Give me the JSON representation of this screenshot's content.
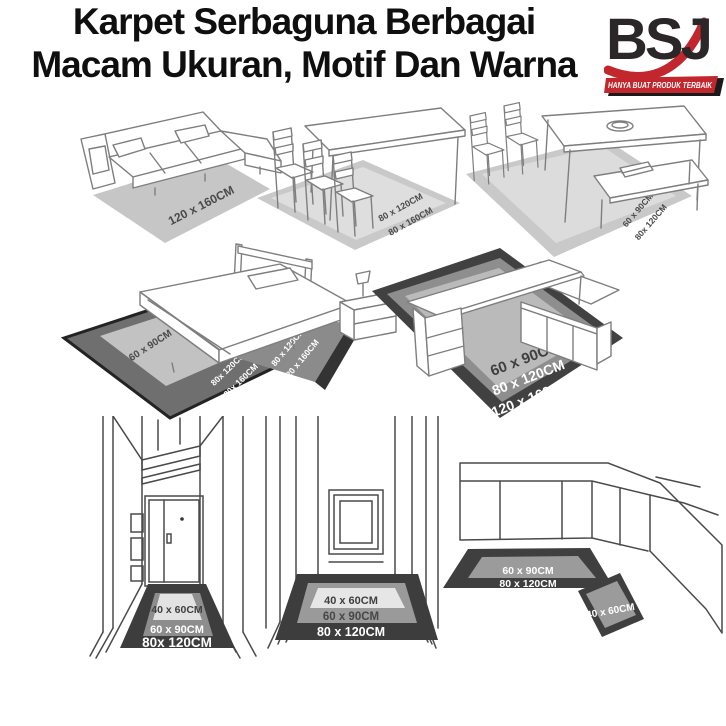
{
  "header": {
    "title_line1": "Karpet Serbaguna Berbagai",
    "title_line2": "Macam Ukuran, Motif Dan Warna"
  },
  "logo": {
    "monogram": "BSJ",
    "tagline": "HANYA BUAT PRODUK TERBAIK"
  },
  "colors": {
    "accent_red": "#c1272d",
    "title_text": "#0f0f0f",
    "carpet_light": "#c9c9c9",
    "carpet_mid": "#8e8e8e",
    "carpet_dark": "#3f3f3f",
    "label_dark": "#4a4a4a",
    "label_light": "#ffffff"
  },
  "scenes": {
    "sofa": {
      "carpet_labels": [
        "120 x 160CM"
      ]
    },
    "dining_table": {
      "carpet_labels": [
        "80 x 120CM",
        "80 x 160CM"
      ]
    },
    "dining_set": {
      "carpet_labels": [
        "60 x 90CM",
        "80x 120CM"
      ]
    },
    "bed": {
      "side_carpet_labels": [
        "60 x 90CM",
        "80x 120CM",
        "120x 160CM"
      ],
      "front_carpet_labels": [
        "80 x 120CM",
        "120 x 160CM"
      ]
    },
    "desk": {
      "carpet_labels": [
        "60 x 90CM",
        "80 x 120CM",
        "120 x 160CM"
      ]
    },
    "hallway_door": {
      "carpet_labels": [
        "40 x 60CM",
        "60 x 90CM",
        "80x 120CM"
      ]
    },
    "hallway_window": {
      "carpet_labels": [
        "40 x 60CM",
        "60 x 90CM",
        "80 x 120CM"
      ]
    },
    "kitchen": {
      "runner_labels": [
        "60 x 90CM",
        "80 x 120CM"
      ],
      "mat_label": "40 x 60CM"
    }
  }
}
